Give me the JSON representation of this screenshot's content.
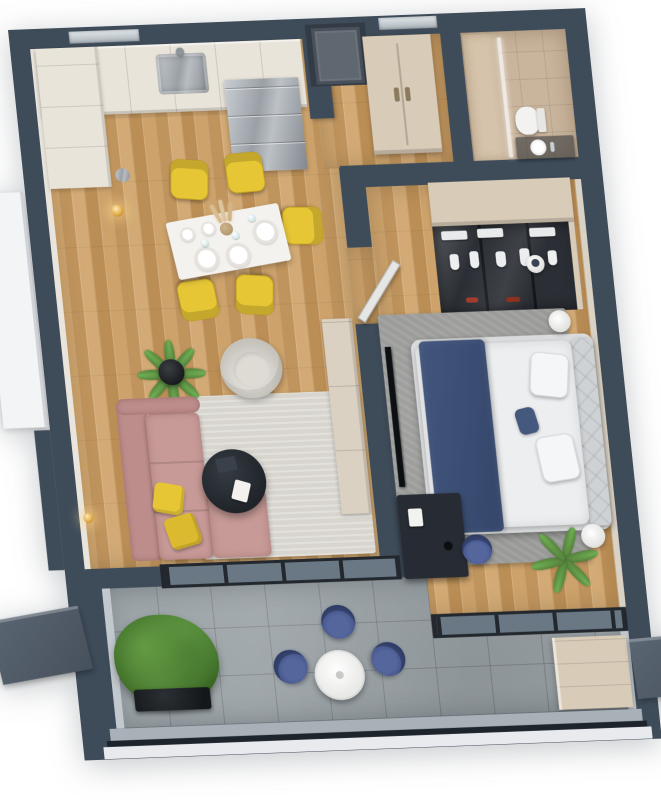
{
  "meta": {
    "type": "3d-floor-plan-render",
    "view": "top-down-axonometric",
    "visible_text": "none"
  },
  "colors": {
    "wall": "#3E4B59",
    "wall_deep": "#2c3640",
    "wall_face": "#e9e5dd",
    "wall_face_cool": "#c2c9ce",
    "wood": "#c99f67",
    "tile": "#99a1a5",
    "bath": "#c9b49c",
    "rug": "#d8d5cf",
    "rug_dark": "#9a9b99",
    "pink": "#c79a97",
    "pink_dark": "#bd8d8b",
    "yellow": "#e7c636",
    "navy": "#3c4e74",
    "blue": "#47598a",
    "green": "#55823c",
    "green_light": "#6fae53",
    "beige": "#d8cbb8",
    "beige_light": "#e9e4da",
    "steel": "#a9aeb4",
    "frame": "#23282e",
    "mattress": "#eceef0",
    "black_t": "#272c31",
    "door_gray": "#5f6770",
    "slab": "#e9eaee",
    "glass": "rgba(173,188,198,0.40)"
  },
  "rooms": [
    "kitchen",
    "dining-area",
    "living-room",
    "entry-hall",
    "bathroom",
    "bedroom",
    "balcony"
  ],
  "furniture": [
    "kitchen-cabinets",
    "kitchen-sink",
    "refrigerator",
    "dining-table-with-plates",
    "yellow-dining-chairs-x5",
    "gold-wall-lamps-x2",
    "potted-palm",
    "lounge-armchair",
    "pink-corner-sofa",
    "yellow-cushions-x2",
    "round-black-coffee-table",
    "light-area-rug",
    "beige-tv-sideboard",
    "wall-mounted-tv",
    "entry-closet",
    "front-door",
    "shower-with-glass",
    "toilet",
    "vanity-basin",
    "glass-front-wardrobe",
    "double-bed-with-navy-throw",
    "round-bedside-tables",
    "writing-desk",
    "blue-desk-chair",
    "gray-bedroom-rug",
    "white-bistro-table",
    "blue-balcony-chairs-x3",
    "green-shrub-in-planter",
    "balcony-storage-cabinet",
    "glass-sliding-walls"
  ]
}
